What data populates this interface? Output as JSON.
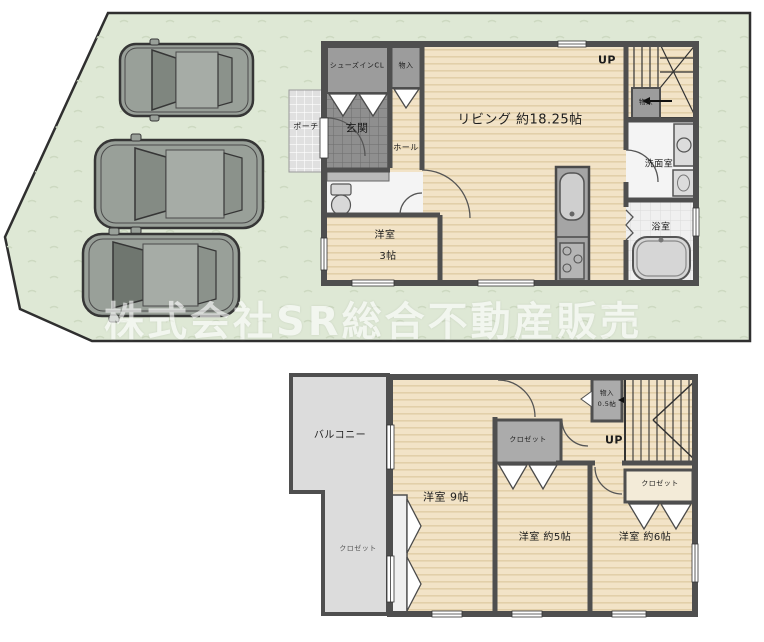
{
  "watermark": "株式会社SR総合不動産販売",
  "floor1": {
    "porch": "ポーチ",
    "shoes_closet": "シューズインCL",
    "entry_storage": "物入",
    "entrance": "玄関",
    "hall": "ホール",
    "living": "リビング 約18.25帖",
    "up": "UP",
    "stair_storage": "物入",
    "washroom": "洗面室",
    "bathroom": "浴室",
    "bedroom_name": "洋室",
    "bedroom_size": "3帖"
  },
  "floor2": {
    "balcony": "バルコニー",
    "bedroom9": "洋室  9帖",
    "closet_left": "クロゼット",
    "closet_center": "クロゼット",
    "closet_right": "クロゼット",
    "storage": "物入",
    "storage_size": "0.5帖",
    "up": "UP",
    "bedroom5": "洋室  約5帖",
    "bedroom6": "洋室  約6帖"
  },
  "colors": {
    "site_green": "#dee8d5",
    "floor_wood": "#f2e3c7",
    "wall_gray": "#4f4f4f",
    "closet_gray": "#ababab",
    "balcony_gray": "#dcdcdc",
    "car_gray": "#99a099",
    "watermark": "#ffffff"
  }
}
